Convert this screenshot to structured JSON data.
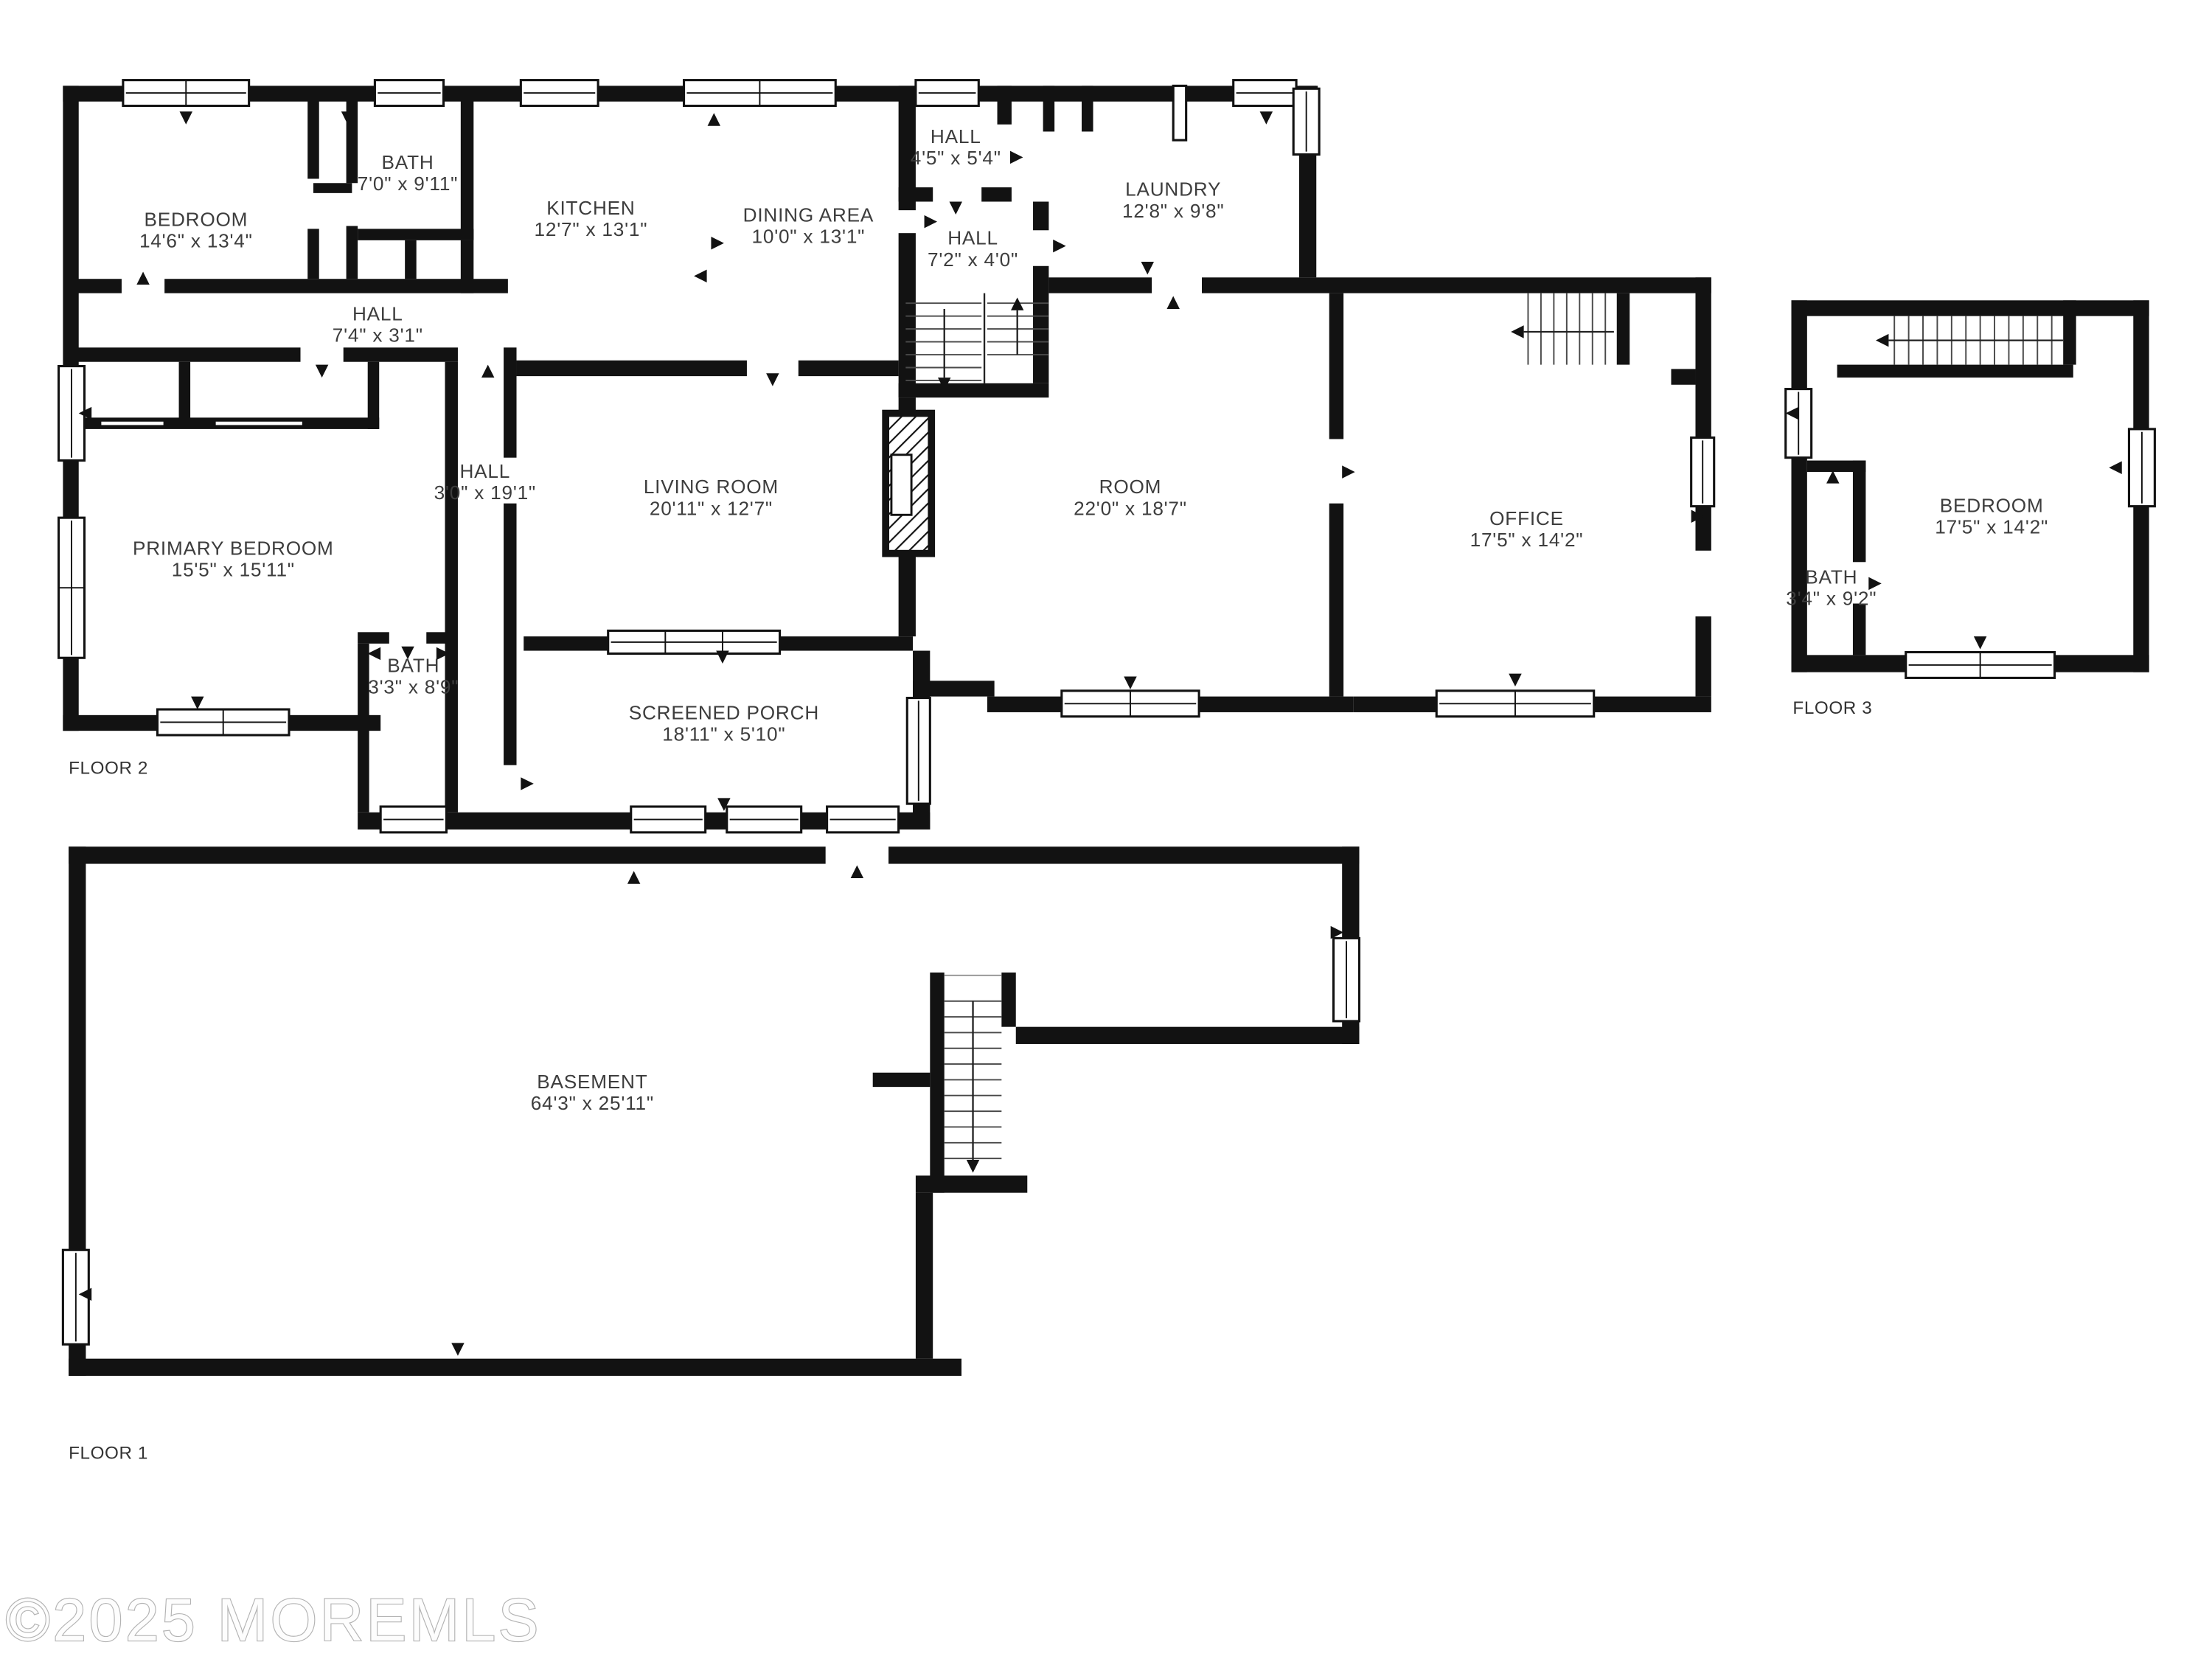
{
  "watermark": "©2025 MOREMLS",
  "floors": {
    "floor1": {
      "label": "FLOOR 1"
    },
    "floor2": {
      "label": "FLOOR 2"
    },
    "floor3": {
      "label": "FLOOR 3"
    }
  },
  "rooms": {
    "bedroom_f2": {
      "name": "BEDROOM",
      "dims": "14'6\" x 13'4\""
    },
    "bath_upper_f2": {
      "name": "BATH",
      "dims": "7'0\" x 9'11\""
    },
    "kitchen": {
      "name": "KITCHEN",
      "dims": "12'7\" x 13'1\""
    },
    "dining_area": {
      "name": "DINING AREA",
      "dims": "10'0\" x 13'1\""
    },
    "hall_top": {
      "name": "HALL",
      "dims": "4'5\" x 5'4\""
    },
    "laundry": {
      "name": "LAUNDRY",
      "dims": "12'8\" x 9'8\""
    },
    "hall_mid": {
      "name": "HALL",
      "dims": "7'2\" x 4'0\""
    },
    "hall_left": {
      "name": "HALL",
      "dims": "7'4\" x 3'1\""
    },
    "primary_bedroom": {
      "name": "PRIMARY BEDROOM",
      "dims": "15'5\" x 15'11\""
    },
    "hall_long": {
      "name": "HALL",
      "dims": "3'0\" x 19'1\""
    },
    "living_room": {
      "name": "LIVING ROOM",
      "dims": "20'11\" x 12'7\""
    },
    "room": {
      "name": "ROOM",
      "dims": "22'0\" x 18'7\""
    },
    "office": {
      "name": "OFFICE",
      "dims": "17'5\" x 14'2\""
    },
    "bath_lower_f2": {
      "name": "BATH",
      "dims": "3'3\" x 8'9\""
    },
    "screened_porch": {
      "name": "SCREENED PORCH",
      "dims": "18'11\" x 5'10\""
    },
    "bedroom_f3": {
      "name": "BEDROOM",
      "dims": "17'5\" x 14'2\""
    },
    "bath_f3": {
      "name": "BATH",
      "dims": "3'4\" x 9'2\""
    },
    "basement": {
      "name": "BASEMENT",
      "dims": "64'3\" x 25'11\""
    }
  }
}
